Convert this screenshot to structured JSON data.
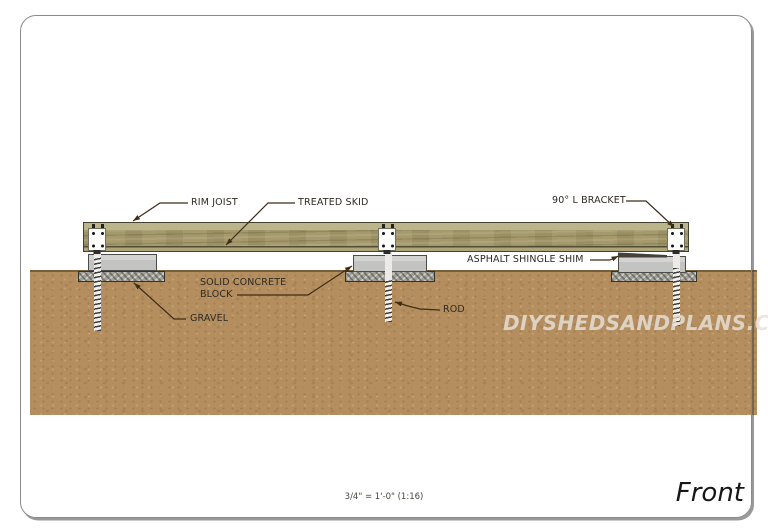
{
  "drawing": {
    "labels": {
      "rim_joist": "RIM JOIST",
      "treated_skid": "TREATED SKID",
      "l_bracket": "90° L BRACKET",
      "shingle_shim": "ASPHALT SHINGLE SHIM",
      "concrete_block": "SOLID CONCRETE BLOCK",
      "gravel": "GRAVEL",
      "rod": "ROD"
    },
    "watermark": "DIYSHEDSANDPLANS.COM",
    "scale_note": "3/4\" = 1'-0\" (1:16)",
    "view_name": "Front"
  },
  "colors": {
    "ground": "#b48e5e",
    "ground-edge": "#76603c",
    "wood-top": "#bcb48a",
    "wood-bottom": "#afa477",
    "wood-border": "#45422f",
    "block-border": "#4c4c48",
    "gravel-fill": "#a3a29a",
    "gravel-border": "#34342f",
    "leader": "#3f2d18",
    "label-text": "#2e2a24",
    "watermark-color": "#e7e2da",
    "sheet-border": "#8a8a8a"
  }
}
